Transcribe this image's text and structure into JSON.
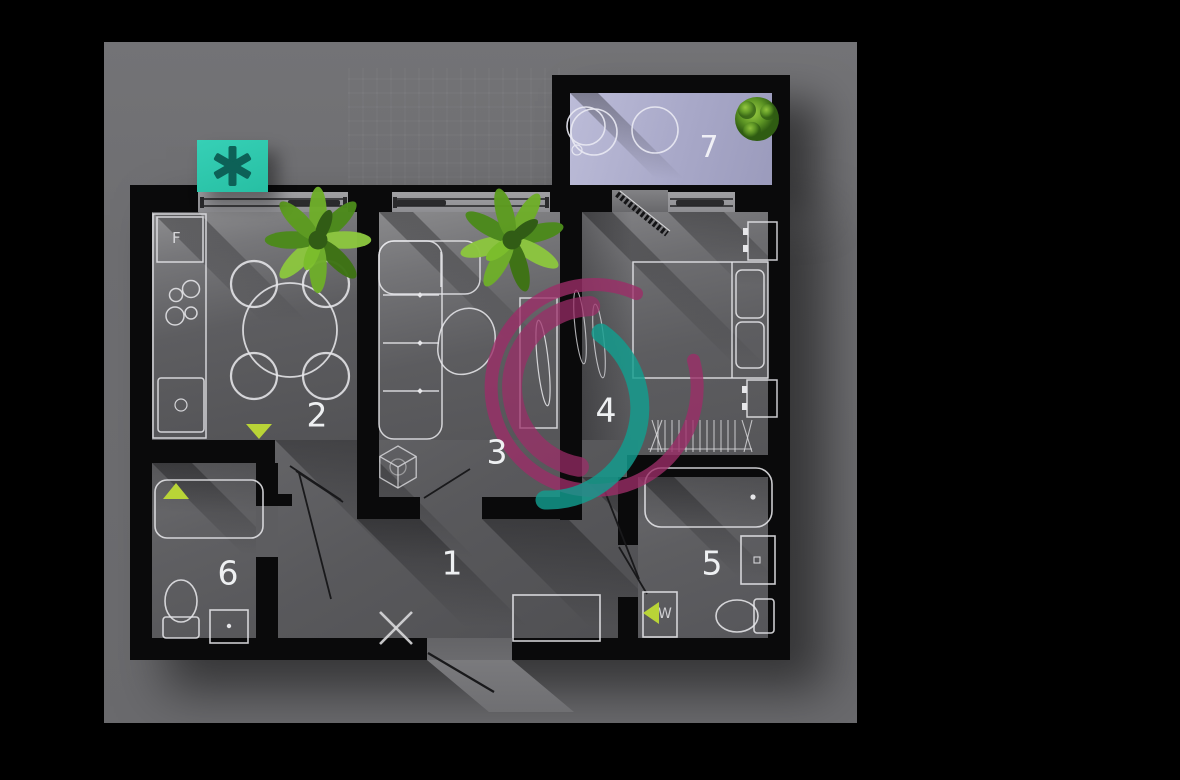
{
  "scene": {
    "background_color": "#000000",
    "panel_color": "#6e6e71"
  },
  "badge": {
    "icon": "asterisk-icon",
    "background_color": "#2fc7ad",
    "icon_color": "#0d6157"
  },
  "watermark": {
    "icon": "spiral-swirl-logo",
    "ring_color": "#9c2d68",
    "swirl_color": "#129e8f"
  },
  "floorplan": {
    "wall_color": "#0a0a0b",
    "balcony_floor_color": "#a8a8c6",
    "door_marker_color": "#b9d437",
    "fridge_label": "F",
    "washer_label": "W",
    "rooms": [
      {
        "number": "1"
      },
      {
        "number": "2"
      },
      {
        "number": "3"
      },
      {
        "number": "4"
      },
      {
        "number": "5"
      },
      {
        "number": "6"
      },
      {
        "number": "7"
      }
    ]
  }
}
